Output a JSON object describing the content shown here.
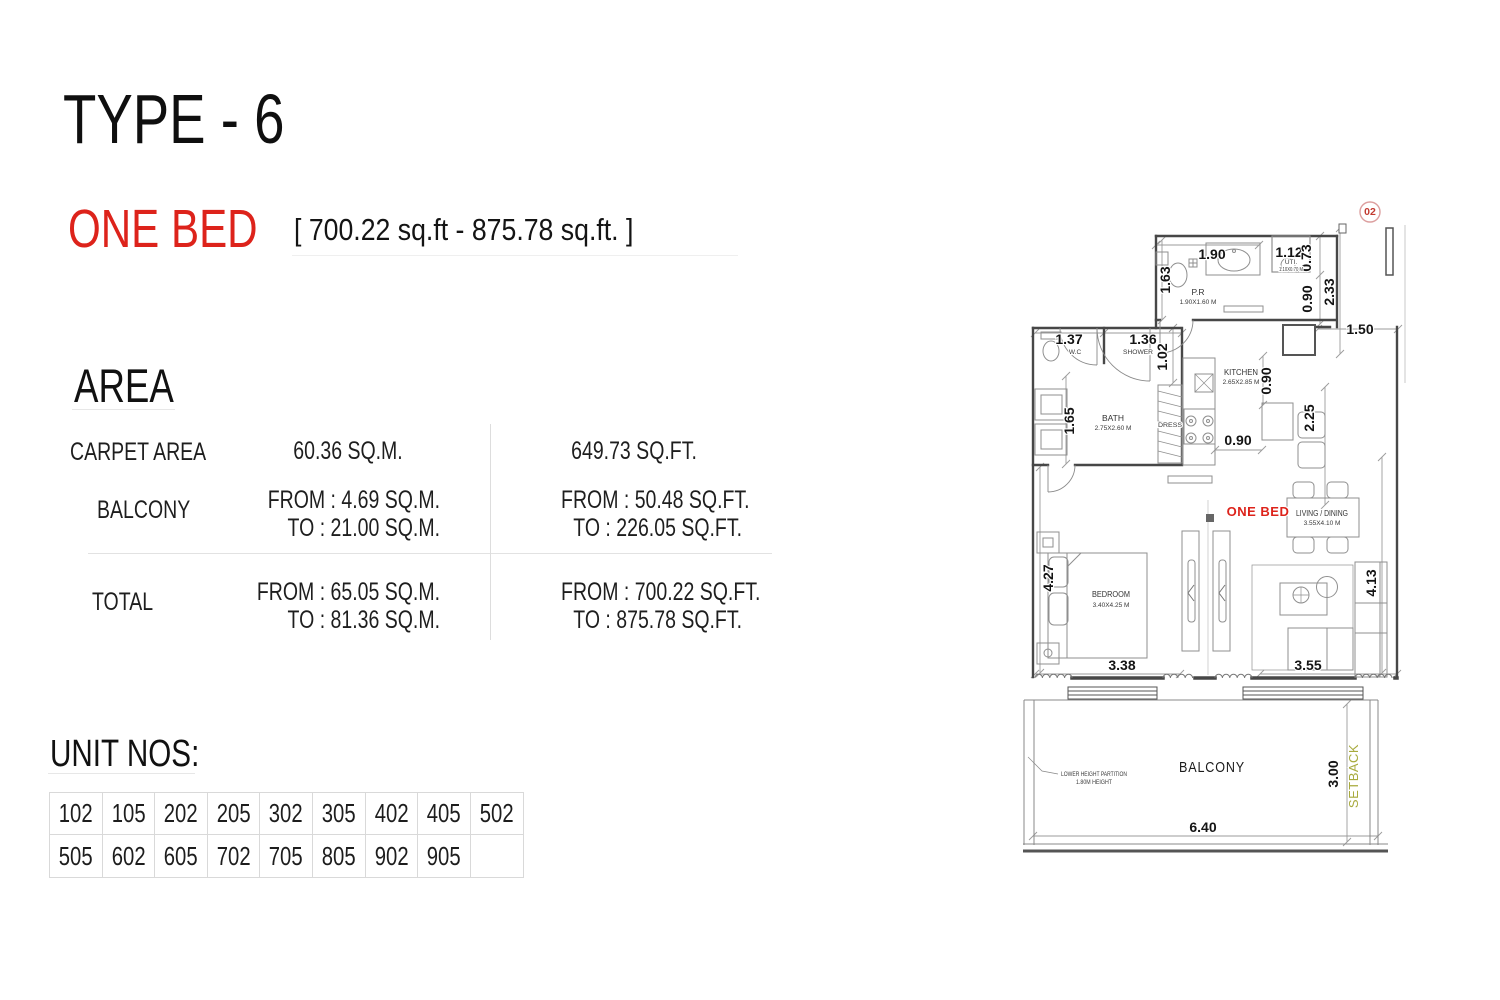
{
  "page": {
    "title": "TYPE - 6",
    "subtitle": "ONE BED",
    "subtitle_range": "[ 700.22 sq.ft - 875.78 sq.ft. ]"
  },
  "area": {
    "heading": "AREA",
    "rows": [
      {
        "label": "CARPET AREA",
        "sqm": "60.36 SQ.M.",
        "sqft": "649.73 SQ.FT."
      },
      {
        "label": "BALCONY",
        "sqm_from": "FROM : 4.69 SQ.M.",
        "sqm_to": "TO : 21.00 SQ.M.",
        "sqft_from": "FROM : 50.48 SQ.FT.",
        "sqft_to": "TO : 226.05 SQ.FT."
      },
      {
        "label": "TOTAL",
        "sqm_from": "FROM : 65.05 SQ.M.",
        "sqm_to": "TO : 81.36 SQ.M.",
        "sqft_from": "FROM : 700.22 SQ.FT.",
        "sqft_to": "TO : 875.78 SQ.FT."
      }
    ]
  },
  "units": {
    "heading": "UNIT NOS:",
    "row1": [
      "102",
      "105",
      "202",
      "205",
      "302",
      "305",
      "402",
      "405",
      "502"
    ],
    "row2": [
      "505",
      "602",
      "605",
      "702",
      "705",
      "805",
      "902",
      "905",
      ""
    ]
  },
  "plan": {
    "unit_badge": "02",
    "one_bed": "ONE BED",
    "rooms": {
      "pr": {
        "name": "P.R",
        "size": "1.90X1.60 M"
      },
      "uti": {
        "name": "UTI.",
        "size": "1.10X0.70 M"
      },
      "wc": {
        "name": "W.C"
      },
      "shower": {
        "name": "SHOWER"
      },
      "bath": {
        "name": "BATH",
        "size": "2.75X2.60 M"
      },
      "dress": {
        "name": "DRESS"
      },
      "kitchen": {
        "name": "KITCHEN",
        "size": "2.65X2.85 M"
      },
      "living": {
        "name": "LIVING / DINING",
        "size": "3.55X4.10 M"
      },
      "bedroom": {
        "name": "BEDROOM",
        "size": "3.40X4.25 M"
      },
      "balcony": {
        "name": "BALCONY"
      }
    },
    "dims": {
      "d190": "1.90",
      "d163": "1.63",
      "d112": "1.12",
      "d073": "0.73",
      "d090_entry": "0.90",
      "d233": "2.33",
      "d150": "1.50",
      "d137": "1.37",
      "d136": "1.36",
      "d102": "1.02",
      "d165": "1.65",
      "d090_kitchen": "0.90",
      "d225": "2.25",
      "d090_corridor": "0.90",
      "d427": "4.27",
      "d413": "4.13",
      "d338": "3.38",
      "d355": "3.55",
      "d300": "3.00",
      "d640": "6.40"
    },
    "notes": {
      "partition_1": "LOWER HEIGHT PARTITION",
      "partition_2": "1.80M HEIGHT",
      "setback": "SETBACK"
    },
    "colors": {
      "accent_red": "#dd231b",
      "setback_olive": "#a8aa3d",
      "badge_red": "#c23a30"
    }
  }
}
